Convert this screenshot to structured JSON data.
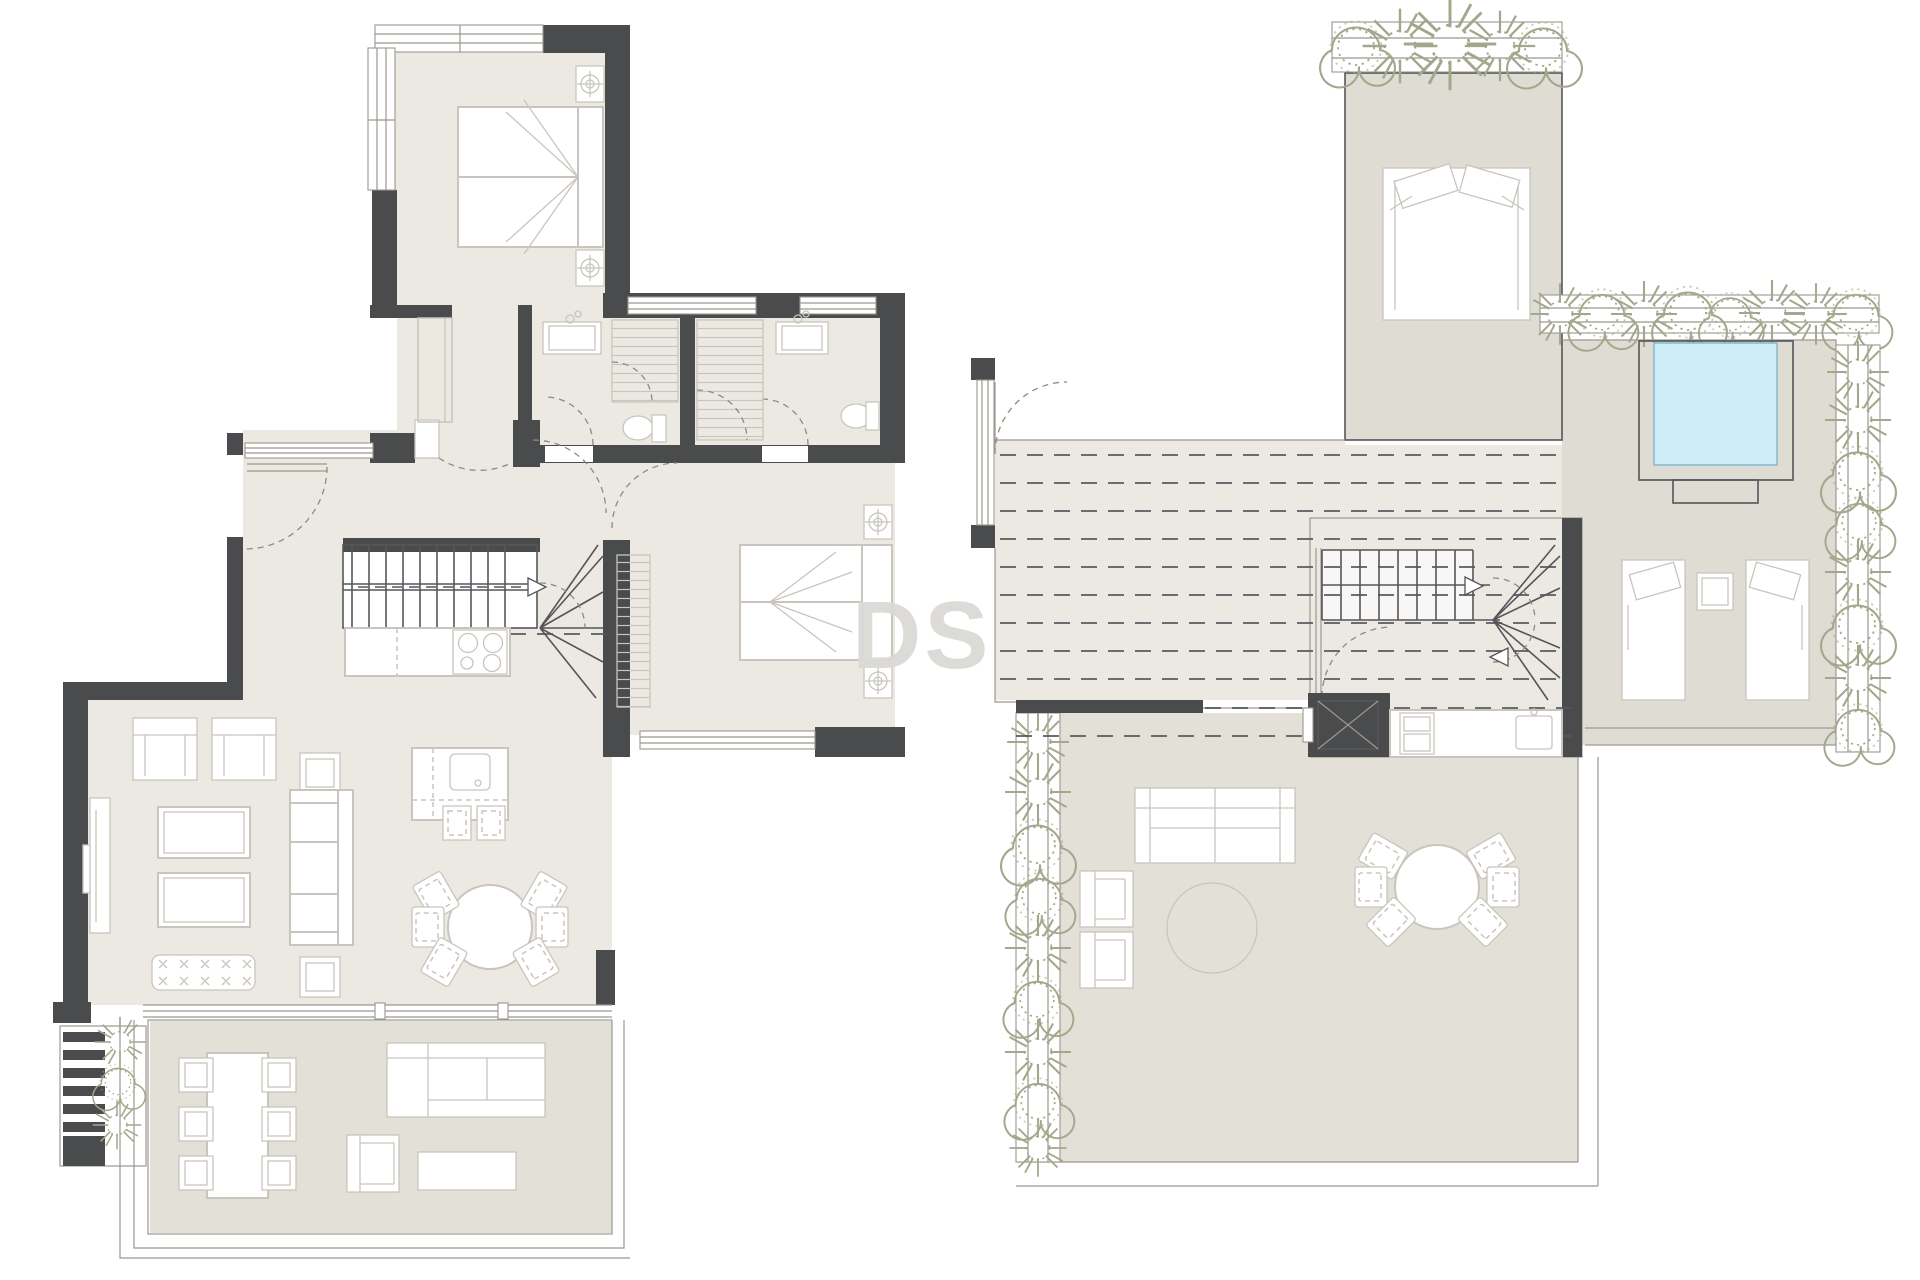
{
  "watermark": {
    "text": "DS"
  },
  "colors": {
    "background": "#ffffff",
    "wall": "#4a4b4d",
    "floor": "#ece9e2",
    "terrace_upper": "#dfdcd4",
    "terrace_lower": "#e3e0d8",
    "furniture": "#c9c5be",
    "line": "#9a988f",
    "dark_line": "#55565a",
    "plant": "#a3a88c",
    "pool": "#cdeef9",
    "pool_edge": "#86b8c9",
    "watermark": "#dbdad6"
  },
  "symbols": {
    "table_lamp": "circle-crosshair",
    "stair_direction_arrow": "triangle",
    "pergola": "dashed-lines",
    "shower": "striped-rect",
    "wardrobe": "striped-rect",
    "ottoman_stitch": "x-marks"
  }
}
